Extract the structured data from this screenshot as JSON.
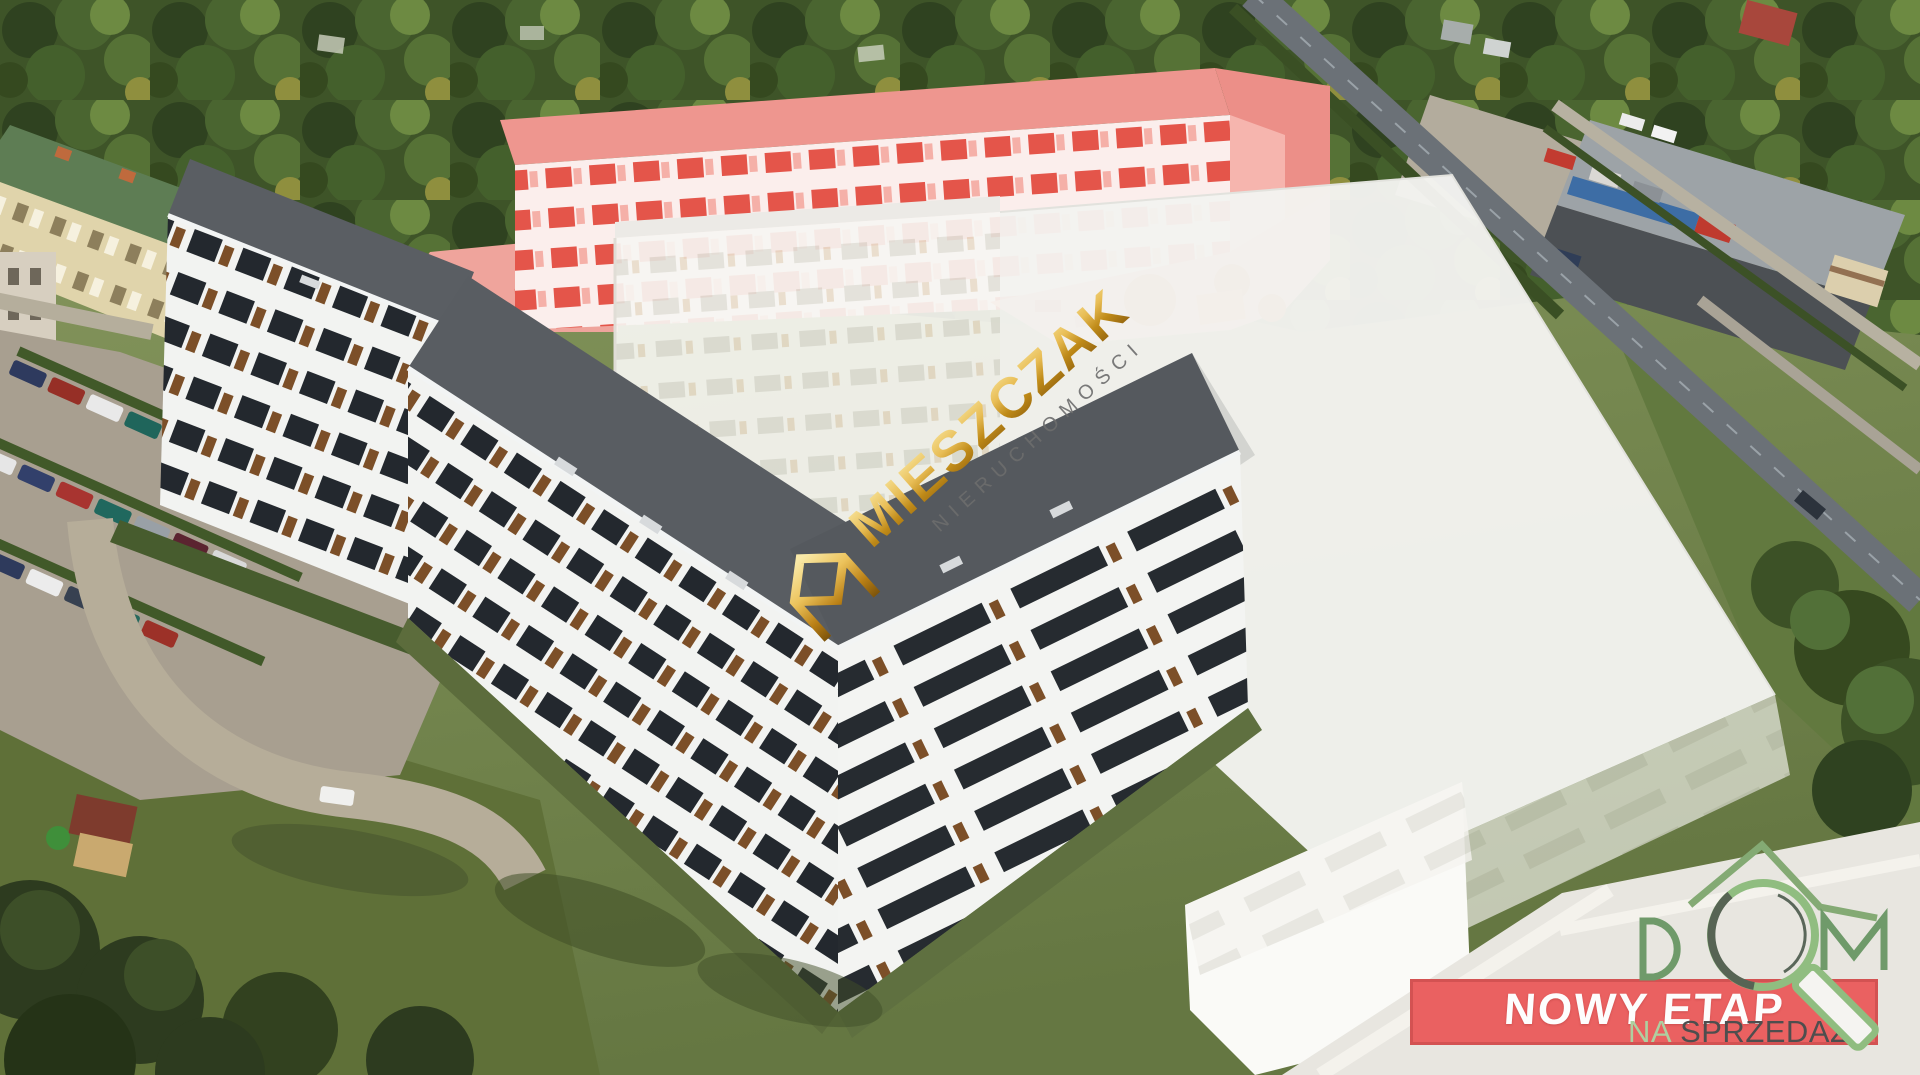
{
  "watermark": {
    "brand": "MIESZCZAK",
    "subtitle": "NIERUCHOMOŚCI"
  },
  "dom_logo": {
    "text": "DOM",
    "tagline_prefix": "NA",
    "tagline_main": "SPRZEDAŻ"
  },
  "banner": {
    "label": "NOWY ETAP"
  },
  "colors": {
    "banner_red": "#ea6161",
    "banner_border": "#d35252",
    "brand_gold": "#c8931f",
    "brand_gold_light": "#f3d27a",
    "brand_gray": "#6d6d6d",
    "logo_green": "#6f9a6a",
    "logo_green_light": "#90bd80",
    "logo_dark": "#576454",
    "tagline_green": "#aecfa0",
    "tagline_gray": "#4e4e4e",
    "highlight_pink": "#ee968f",
    "roof_gray": "#595d62"
  },
  "icons": {
    "watermark_icon": "gold-m-house",
    "dom_magnifier_icon": "magnifying-glass",
    "dom_roof_icon": "house-roof"
  }
}
